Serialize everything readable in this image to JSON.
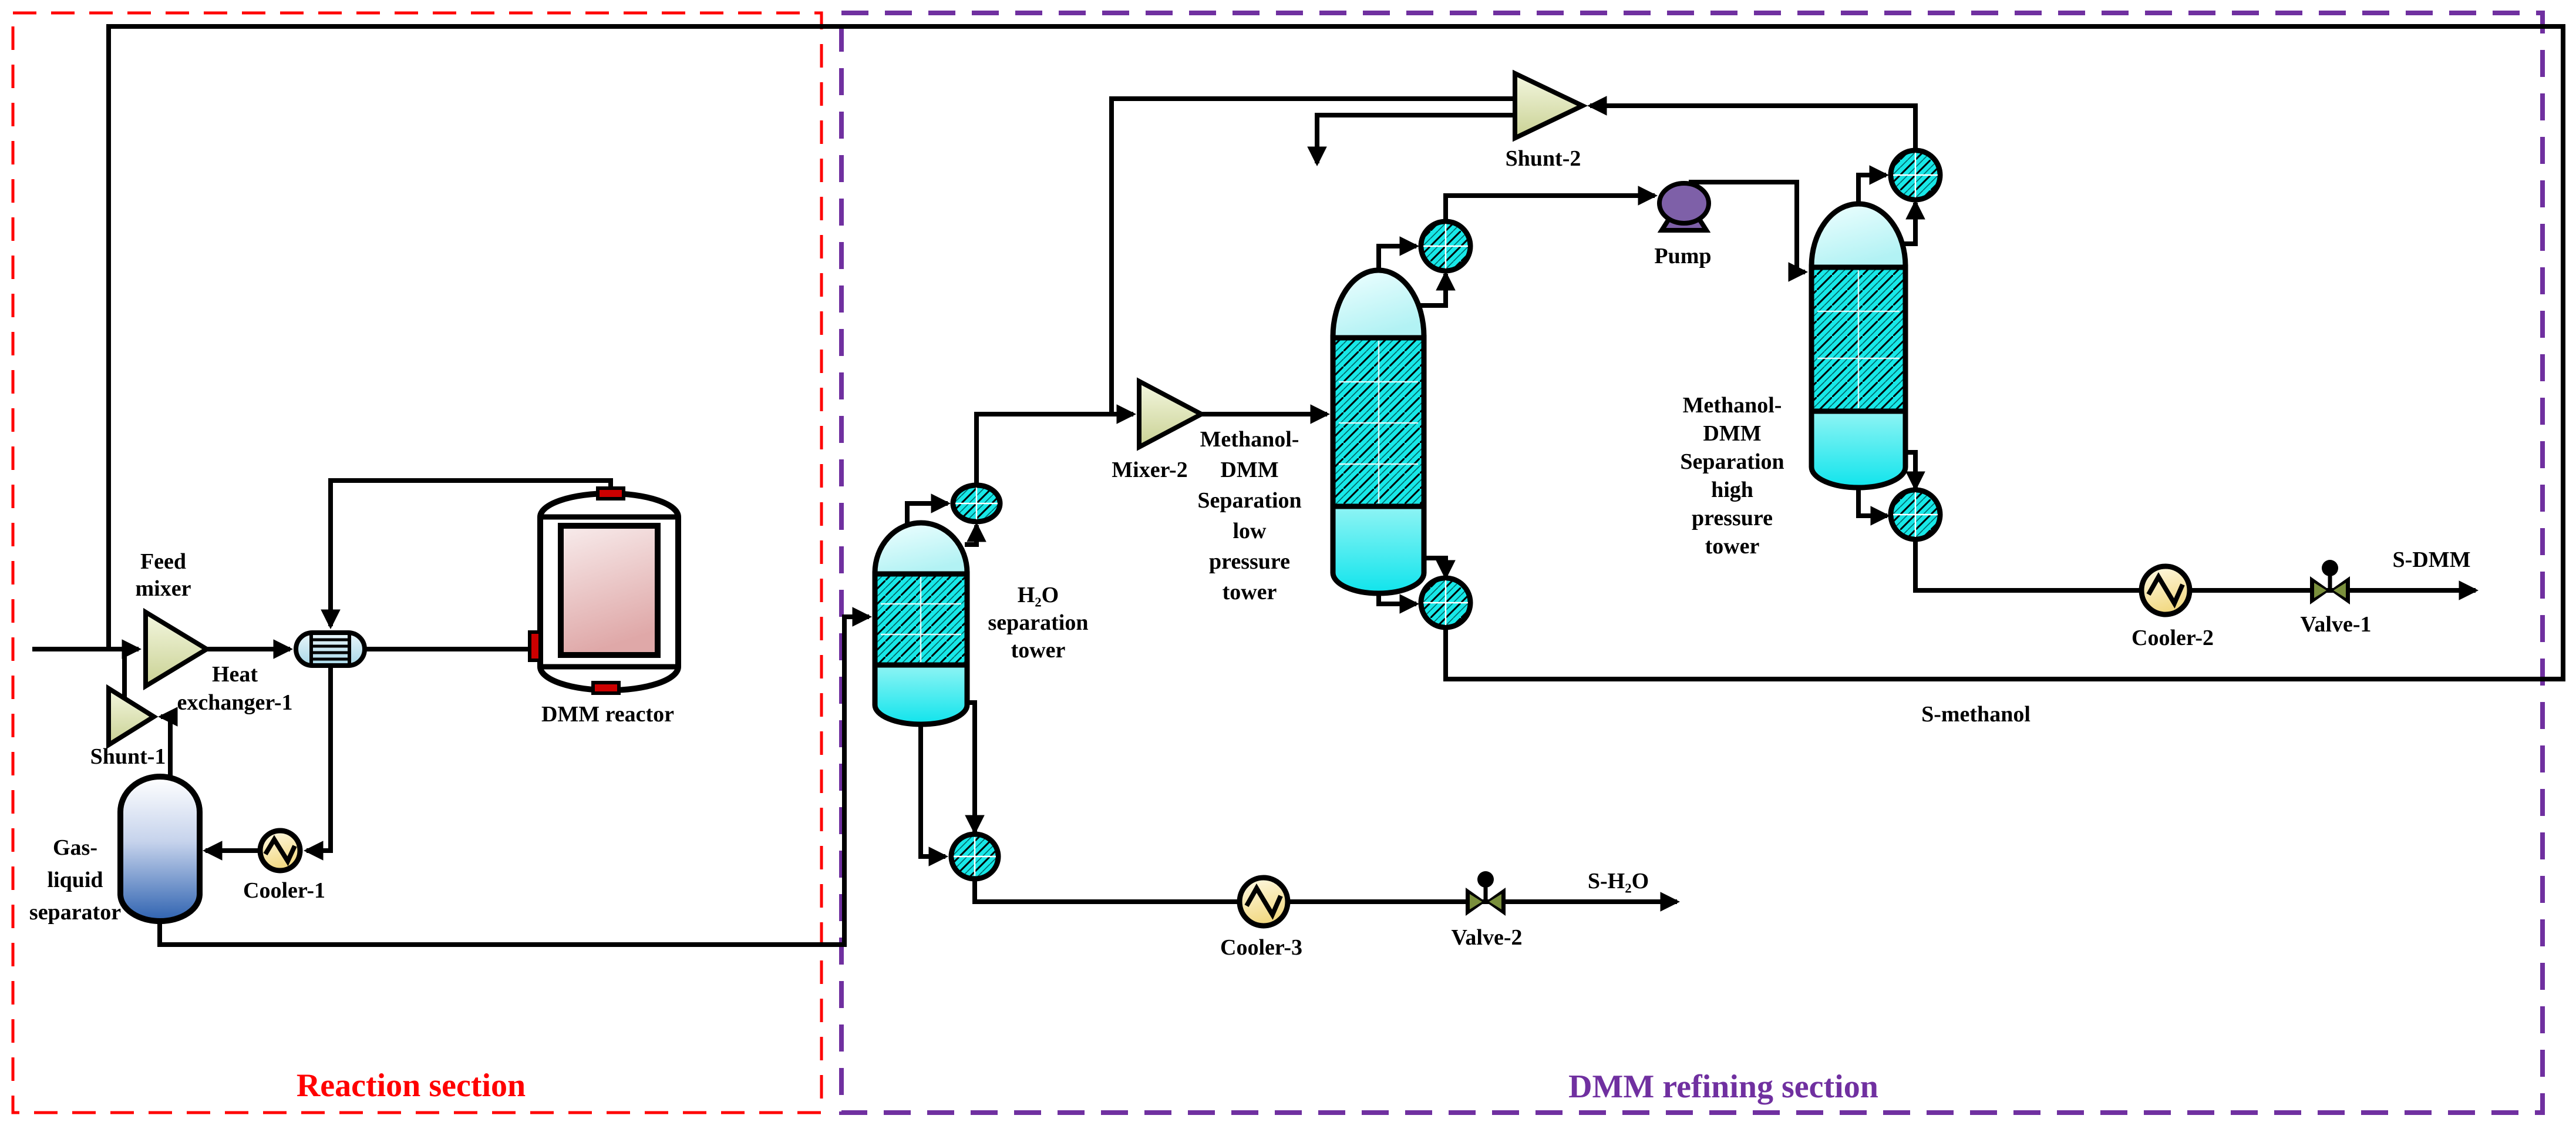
{
  "sections": {
    "reaction": "Reaction section",
    "refining": "DMM refining section"
  },
  "labels": {
    "feed_mixer": [
      "Feed",
      "mixer"
    ],
    "shunt_1": "Shunt-1",
    "heat_exchanger_1": [
      "Heat",
      "exchanger-1"
    ],
    "dmm_reactor": "DMM reactor",
    "gas_liquid_separator": [
      "Gas-",
      "liquid",
      "separator"
    ],
    "cooler_1": "Cooler-1",
    "h2o_tower": [
      "H₂O",
      "separation",
      "tower"
    ],
    "mixer_2": "Mixer-2",
    "lp_tower": [
      "Methanol-",
      "DMM",
      "Separation",
      "low",
      "pressure",
      "tower"
    ],
    "shunt_2": "Shunt-2",
    "pump": "Pump",
    "hp_tower": [
      "Methanol-",
      "DMM",
      "Separation",
      "high",
      "pressure",
      "tower"
    ],
    "cooler_2": "Cooler-2",
    "valve_1": "Valve-1",
    "cooler_3": "Cooler-3",
    "valve_2": "Valve-2"
  },
  "streams": {
    "s_dmm": "S-DMM",
    "s_methanol": "S-methanol",
    "s_h2o": "S-H₂O"
  },
  "colors": {
    "section_reaction": "#FF0000",
    "section_refining": "#7030A0",
    "packing_cyan": "#17E8E8",
    "tower_top_cyan": "#D8FBFB",
    "tower_bottom_cyan": "#20E6EE",
    "pump_purple": "#7E60A8",
    "cooler_yellow": "#F2D983",
    "reactor_pink": "#DFA8A8",
    "separator_blue": "#2E62B0",
    "nozzle_red": "#CC0000",
    "valve_olive": "#7A8F3C",
    "triangle_olive": "#C9D193",
    "hx_blue": "#A8D8E8",
    "line_black": "#000000"
  }
}
